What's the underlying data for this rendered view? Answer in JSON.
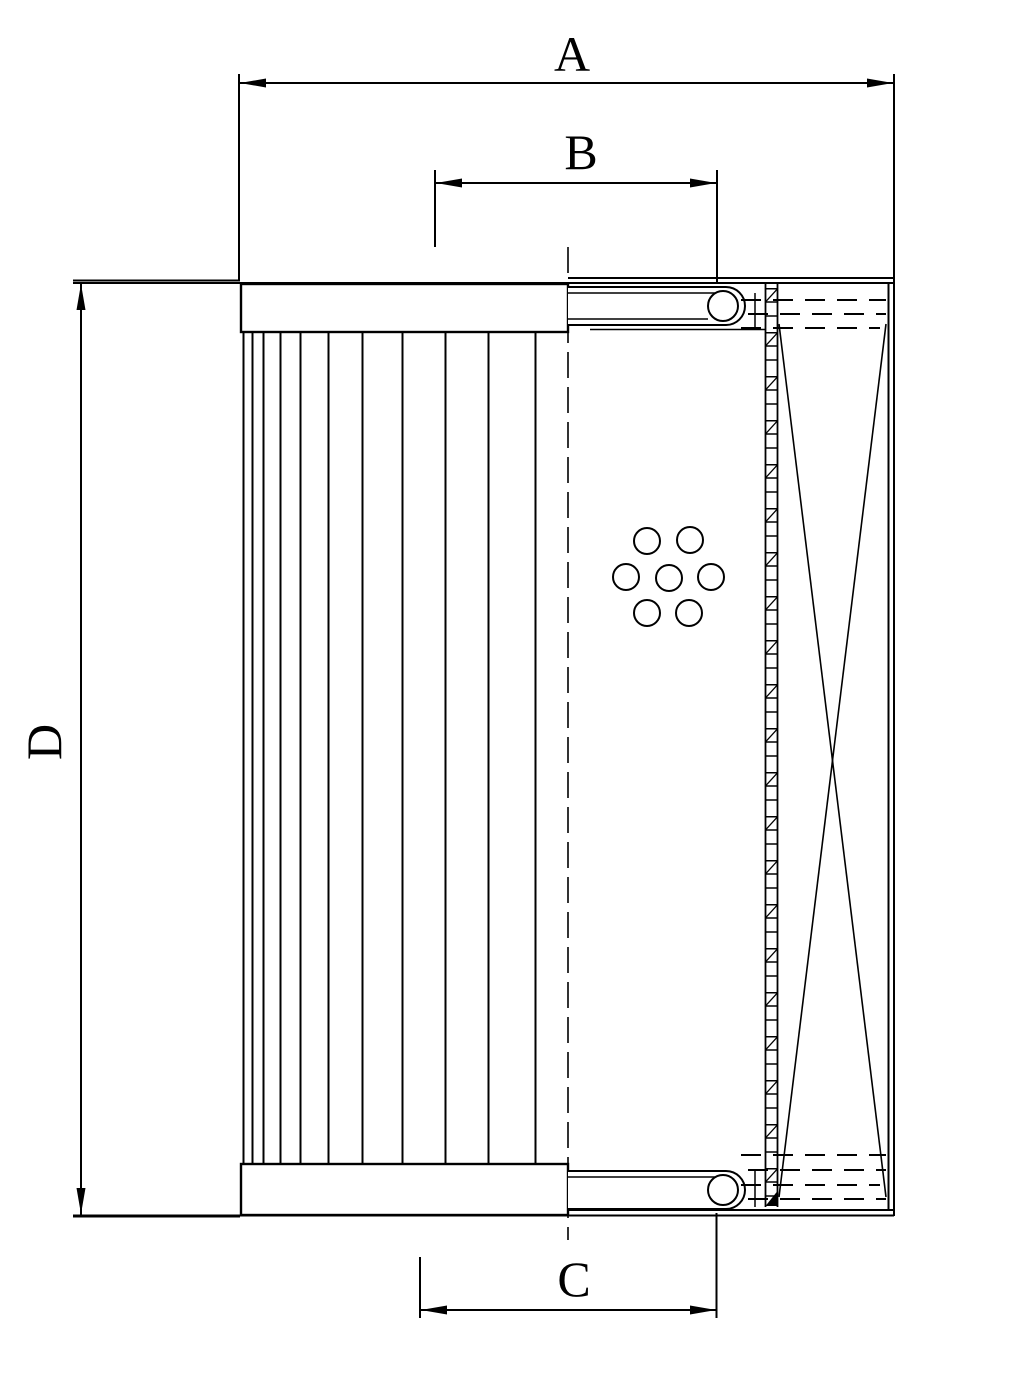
{
  "figure": {
    "type": "technical-drawing",
    "subject": "filter element half-section drawing",
    "background_color": "#ffffff",
    "line_color": "#000000"
  },
  "dimension_labels": {
    "a": "A",
    "b": "B",
    "c": "C",
    "d": "D"
  }
}
